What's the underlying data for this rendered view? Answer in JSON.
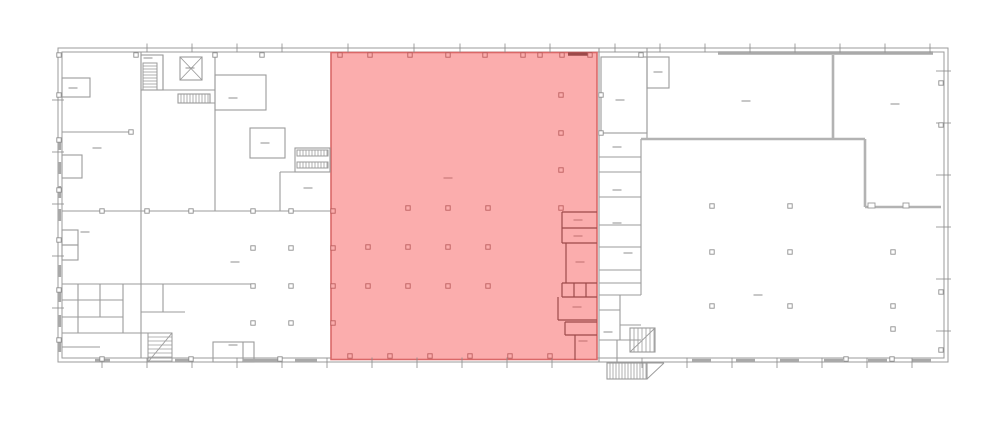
{
  "canvas": {
    "width": 1000,
    "height": 426,
    "background": "#ffffff"
  },
  "colors": {
    "wall": "#9b9b9b",
    "wall_light": "#b3b3b3",
    "window": "#a9a9a9",
    "tick": "#8a8a8a",
    "label": "#8f8f8f",
    "column_stroke": "#8f8f8f",
    "column_fill": "#ffffff",
    "highlight_fill": "#fbadad",
    "highlight_stroke": "#da6868",
    "highlight_wall": "#9c4a4a",
    "highlight_label": "#bf6e6e",
    "highlight_column_stroke": "#bb5f5f",
    "highlight_column_fill": "#fbadad"
  },
  "building": {
    "outer_rect": [
      58,
      48,
      890,
      314
    ],
    "inner_rect": [
      62,
      52,
      882,
      306
    ]
  },
  "highlight_zone": {
    "x": 331,
    "y": 52.5,
    "width": 266,
    "height": 307,
    "label_dash": [
      448,
      178
    ]
  },
  "walls_gray": [
    [
      141,
      52,
      141,
      358
    ],
    [
      215,
      52,
      215,
      211
    ],
    [
      62,
      132,
      131,
      132
    ],
    [
      62,
      211,
      330,
      211
    ],
    [
      62,
      284,
      254,
      284
    ],
    [
      163,
      55,
      163,
      90
    ],
    [
      163,
      90,
      215,
      90
    ],
    [
      178,
      103,
      215,
      103
    ],
    [
      280,
      172,
      330,
      172
    ],
    [
      280,
      172,
      280,
      211
    ],
    [
      78,
      284,
      78,
      333
    ],
    [
      100,
      284,
      100,
      317
    ],
    [
      123,
      284,
      123,
      333
    ],
    [
      62,
      300,
      123,
      300
    ],
    [
      62,
      317,
      123,
      317
    ],
    [
      62,
      333,
      148,
      333
    ],
    [
      62,
      347,
      100,
      347
    ],
    [
      163,
      284,
      163,
      312
    ],
    [
      141,
      312,
      185,
      312
    ],
    [
      243,
      342,
      243,
      362
    ],
    [
      599,
      48,
      599,
      362
    ],
    [
      647,
      48,
      647,
      139
    ],
    [
      641,
      139,
      641,
      295
    ],
    [
      599,
      157,
      641,
      157
    ],
    [
      599,
      172,
      641,
      172
    ],
    [
      599,
      197,
      641,
      197
    ],
    [
      599,
      225,
      641,
      225
    ],
    [
      599,
      247,
      641,
      247
    ],
    [
      599,
      270,
      641,
      270
    ],
    [
      599,
      283,
      641,
      283
    ],
    [
      599,
      295,
      641,
      295
    ],
    [
      620,
      295,
      620,
      340
    ],
    [
      599,
      310,
      620,
      310
    ],
    [
      620,
      325,
      641,
      325
    ],
    [
      599,
      340,
      641,
      340
    ],
    [
      617,
      340,
      617,
      362
    ]
  ],
  "walls_gray_thick": [
    [
      865,
      139,
      865,
      207
    ],
    [
      865,
      207,
      941,
      207
    ],
    [
      833,
      55,
      833,
      139
    ],
    [
      641,
      139,
      865,
      139
    ]
  ],
  "rooms_gray": [
    [
      62,
      78,
      28,
      19
    ],
    [
      62,
      155,
      20,
      23
    ],
    [
      62,
      230,
      16,
      15
    ],
    [
      62,
      245,
      16,
      15
    ],
    [
      141,
      55,
      22,
      35
    ],
    [
      180,
      57,
      22,
      23
    ],
    [
      178,
      94,
      32,
      9
    ],
    [
      215,
      75,
      51,
      35
    ],
    [
      250,
      128,
      35,
      30
    ],
    [
      295,
      148,
      35,
      24
    ],
    [
      213,
      342,
      41,
      20
    ],
    [
      601,
      57,
      46,
      76
    ],
    [
      647,
      57,
      22,
      31
    ],
    [
      630,
      328,
      25,
      24
    ],
    [
      607,
      363,
      40,
      16
    ]
  ],
  "door_notches": [
    [
      868,
      203,
      7,
      5
    ],
    [
      903,
      203,
      6,
      5
    ]
  ],
  "stairs": [
    {
      "x": 143,
      "y": 63,
      "w": 14,
      "h": 27,
      "dir": "h",
      "gap": 3
    },
    {
      "x": 178,
      "y": 94,
      "w": 32,
      "h": 9,
      "dir": "v",
      "gap": 3
    },
    {
      "x": 297,
      "y": 150,
      "w": 31,
      "h": 6,
      "dir": "v",
      "gap": 3
    },
    {
      "x": 297,
      "y": 162,
      "w": 31,
      "h": 6,
      "dir": "v",
      "gap": 3
    },
    {
      "x": 607,
      "y": 363,
      "w": 40,
      "h": 16,
      "dir": "v",
      "gap": 3
    },
    {
      "x": 630,
      "y": 328,
      "w": 25,
      "h": 24,
      "dir": "v",
      "gap": 4
    },
    {
      "x": 148,
      "y": 333,
      "w": 24,
      "h": 29,
      "dir": "h",
      "gap": 4
    }
  ],
  "diagonals": [
    [
      630,
      352,
      655,
      328
    ],
    [
      148,
      362,
      172,
      333
    ],
    [
      647,
      379,
      664,
      363
    ],
    [
      647,
      363,
      664,
      363
    ],
    [
      180,
      57,
      202,
      80
    ],
    [
      202,
      57,
      180,
      80
    ]
  ],
  "window_segments": {
    "top": [
      [
        718,
        215
      ]
    ],
    "bottom": [
      [
        95,
        15
      ],
      [
        175,
        17
      ],
      [
        243,
        37
      ],
      [
        295,
        22
      ],
      [
        692,
        19
      ],
      [
        736,
        19
      ],
      [
        780,
        19
      ],
      [
        824,
        19
      ],
      [
        868,
        19
      ],
      [
        912,
        19
      ]
    ],
    "left": [
      138,
      162,
      186,
      209,
      265,
      290,
      315,
      340
    ]
  },
  "highlight_walls": [
    [
      562,
      212,
      597,
      212
    ],
    [
      562,
      212,
      562,
      243
    ],
    [
      562,
      228,
      597,
      228
    ],
    [
      562,
      243,
      597,
      243
    ],
    [
      566,
      243,
      566,
      283
    ],
    [
      562,
      283,
      597,
      283
    ],
    [
      562,
      283,
      562,
      297
    ],
    [
      574,
      283,
      574,
      297
    ],
    [
      586,
      283,
      586,
      297
    ],
    [
      562,
      297,
      597,
      297
    ],
    [
      558,
      297,
      558,
      320
    ],
    [
      558,
      320,
      597,
      320
    ],
    [
      565,
      322,
      597,
      322
    ],
    [
      565,
      322,
      565,
      335
    ],
    [
      565,
      335,
      597,
      335
    ],
    [
      575,
      335,
      575,
      360
    ]
  ],
  "highlight_window_top": [
    568,
    54,
    592,
    54
  ],
  "columns_gray": [
    [
      253,
      248
    ],
    [
      291,
      248
    ],
    [
      253,
      286
    ],
    [
      291,
      286
    ],
    [
      253,
      323
    ],
    [
      291,
      323
    ],
    [
      712,
      206
    ],
    [
      790,
      206
    ],
    [
      712,
      252
    ],
    [
      790,
      252
    ],
    [
      893,
      252
    ],
    [
      712,
      306
    ],
    [
      790,
      306
    ],
    [
      893,
      306
    ],
    [
      893,
      329
    ],
    [
      59,
      55
    ],
    [
      136,
      55
    ],
    [
      215,
      55
    ],
    [
      262,
      55
    ],
    [
      59,
      95
    ],
    [
      59,
      140
    ],
    [
      59,
      190
    ],
    [
      59,
      240
    ],
    [
      59,
      290
    ],
    [
      59,
      340
    ],
    [
      102,
      211
    ],
    [
      147,
      211
    ],
    [
      191,
      211
    ],
    [
      253,
      211
    ],
    [
      291,
      211
    ],
    [
      131,
      132
    ],
    [
      941,
      83
    ],
    [
      941,
      125
    ],
    [
      941,
      292
    ],
    [
      941,
      350
    ],
    [
      846,
      359
    ],
    [
      892,
      359
    ],
    [
      102,
      359
    ],
    [
      191,
      359
    ],
    [
      280,
      359
    ],
    [
      601,
      95
    ],
    [
      601,
      133
    ],
    [
      641,
      55
    ]
  ],
  "columns_highlight": [
    [
      340,
      55
    ],
    [
      370,
      55
    ],
    [
      410,
      55
    ],
    [
      448,
      55
    ],
    [
      485,
      55
    ],
    [
      523,
      55
    ],
    [
      540,
      55
    ],
    [
      562,
      55
    ],
    [
      590,
      55
    ],
    [
      350,
      356
    ],
    [
      390,
      356
    ],
    [
      430,
      356
    ],
    [
      470,
      356
    ],
    [
      510,
      356
    ],
    [
      550,
      356
    ],
    [
      333,
      211
    ],
    [
      333,
      248
    ],
    [
      333,
      286
    ],
    [
      333,
      323
    ],
    [
      368,
      247
    ],
    [
      408,
      247
    ],
    [
      448,
      247
    ],
    [
      488,
      247
    ],
    [
      408,
      208
    ],
    [
      448,
      208
    ],
    [
      488,
      208
    ],
    [
      368,
      286
    ],
    [
      408,
      286
    ],
    [
      448,
      286
    ],
    [
      488,
      286
    ],
    [
      561,
      95
    ],
    [
      561,
      133
    ],
    [
      561,
      170
    ],
    [
      561,
      208
    ]
  ],
  "ticks": {
    "top_x": [
      147,
      192,
      237,
      282,
      348,
      414,
      460,
      505,
      550,
      615,
      660,
      705,
      750,
      795,
      840,
      885,
      930
    ],
    "bottom_x": [
      102,
      147,
      192,
      237,
      282,
      327,
      372,
      417,
      462,
      507,
      552,
      642,
      687,
      732,
      777,
      822,
      867,
      912
    ],
    "left_y": [
      100,
      152,
      204,
      256,
      308
    ],
    "right_y": [
      71,
      123,
      175,
      227,
      279,
      331
    ]
  },
  "label_dashes_gray": [
    [
      73,
      88
    ],
    [
      148,
      58
    ],
    [
      190,
      68
    ],
    [
      233,
      98
    ],
    [
      265,
      143
    ],
    [
      308,
      188
    ],
    [
      97,
      148
    ],
    [
      85,
      232
    ],
    [
      235,
      262
    ],
    [
      233,
      345
    ],
    [
      620,
      100
    ],
    [
      658,
      72
    ],
    [
      746,
      101
    ],
    [
      895,
      104
    ],
    [
      617,
      147
    ],
    [
      617,
      190
    ],
    [
      617,
      223
    ],
    [
      628,
      253
    ],
    [
      608,
      332
    ],
    [
      758,
      295
    ]
  ],
  "label_dashes_highlight": [
    [
      448,
      178
    ],
    [
      578,
      220
    ],
    [
      578,
      236
    ],
    [
      580,
      262
    ],
    [
      577,
      307
    ],
    [
      583,
      341
    ]
  ]
}
